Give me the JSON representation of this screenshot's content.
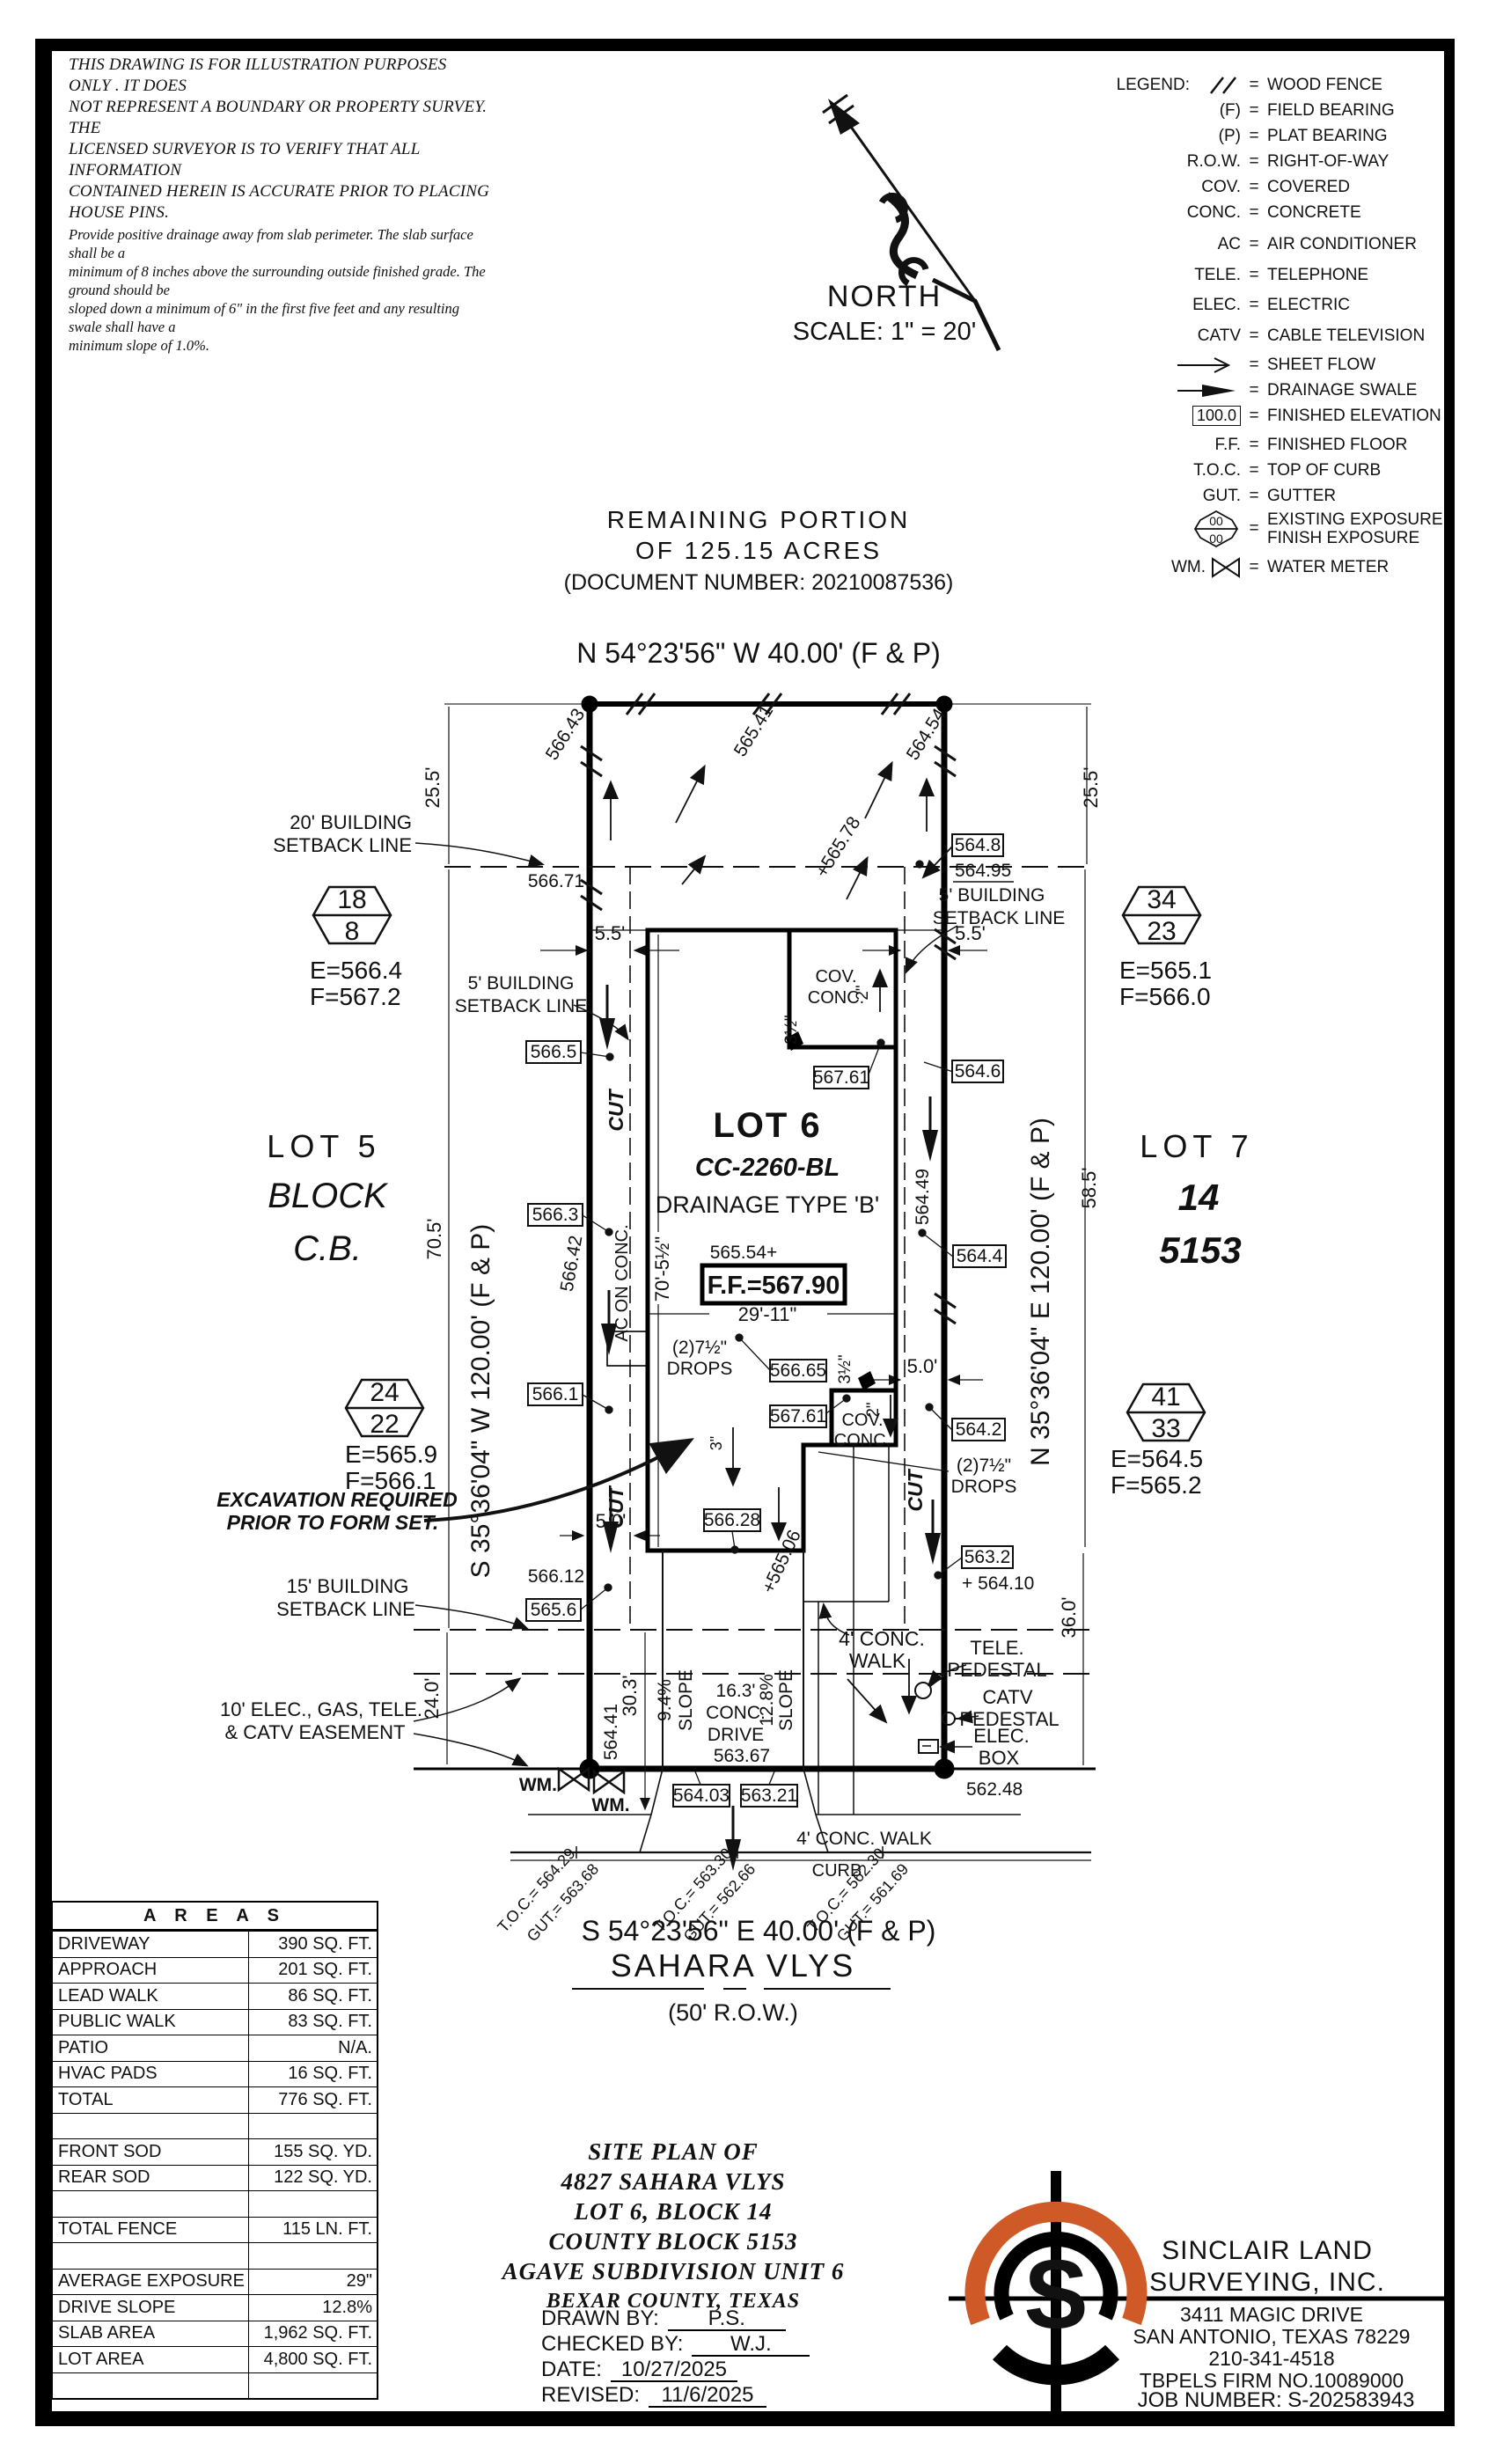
{
  "disclaimer": {
    "l1": "THIS DRAWING IS FOR ILLUSTRATION PURPOSES ONLY . IT DOES",
    "l2": "NOT REPRESENT A BOUNDARY OR PROPERTY SURVEY. THE",
    "l3": "LICENSED SURVEYOR IS TO VERIFY THAT ALL INFORMATION",
    "l4": "CONTAINED HEREIN IS ACCURATE PRIOR TO PLACING HOUSE PINS.",
    "n1": "Provide positive drainage away from slab perimeter. The slab surface shall be a",
    "n2": "minimum of 8 inches above the surrounding outside finished grade. The ground should be",
    "n3": "sloped down a minimum of 6\" in the first five feet and any resulting swale shall have a",
    "n4": "minimum slope of 1.0%."
  },
  "north": {
    "label": "NORTH",
    "scale": "SCALE:  1\" = 20'"
  },
  "legend": {
    "title": "LEGEND:",
    "exp_top": "00",
    "exp_bot": "00",
    "wm": "WM.",
    "items": [
      {
        "sym": "",
        "label": "WOOD FENCE"
      },
      {
        "sym": "(F)",
        "label": "FIELD BEARING"
      },
      {
        "sym": "(P)",
        "label": "PLAT BEARING"
      },
      {
        "sym": "R.O.W.",
        "label": "RIGHT-OF-WAY"
      },
      {
        "sym": "COV.",
        "label": "COVERED"
      },
      {
        "sym": "CONC.",
        "label": "CONCRETE"
      },
      {
        "sym": "AC",
        "label": "AIR CONDITIONER"
      },
      {
        "sym": "TELE.",
        "label": "TELEPHONE"
      },
      {
        "sym": "ELEC.",
        "label": "ELECTRIC"
      },
      {
        "sym": "CATV",
        "label": "CABLE TELEVISION"
      },
      {
        "sym": "",
        "label": "SHEET FLOW"
      },
      {
        "sym": "",
        "label": "DRAINAGE SWALE"
      },
      {
        "sym": "100.0",
        "label": "FINISHED ELEVATION"
      },
      {
        "sym": "F.F.",
        "label": "FINISHED FLOOR"
      },
      {
        "sym": "T.O.C.",
        "label": "TOP OF CURB"
      },
      {
        "sym": "GUT.",
        "label": "GUTTER"
      },
      {
        "sym": "",
        "label": "EXISTING EXPOSURE",
        "label2": "FINISH EXPOSURE"
      },
      {
        "sym": "WM.",
        "label": "WATER METER"
      }
    ]
  },
  "plan": {
    "remaining1": "REMAINING PORTION",
    "remaining2": "OF 125.15 ACRES",
    "remaining3": "(DOCUMENT NUMBER: 20210087536)",
    "top_bearing": "N 54°23'56\" W 40.00' (F & P)",
    "left_bearing": "S 35°36'04\" W 120.00' (F & P)",
    "right_bearing": "N 35°36'04\" E 120.00' (F & P)",
    "bottom_bearing": "S 54°23'56\" E 40.00' (F & P)",
    "street_name": "SAHARA VLYS",
    "street_row": "(50' R.O.W.)",
    "lot5": "LOT 5",
    "block": "BLOCK",
    "cb": "C.B.",
    "lot6": "LOT 6",
    "cc": "CC-2260-BL",
    "drainage": "DRAINAGE TYPE 'B'",
    "pad_elev": "565.54+",
    "ff": "F.F.=567.90",
    "lot7": "LOT 7",
    "b14": "14",
    "cb5153": "5153",
    "sb20a": "20' BUILDING",
    "sb20b": "SETBACK LINE",
    "sb5a": "5' BUILDING",
    "sb5b": "SETBACK LINE",
    "sb15a": "15' BUILDING",
    "sb15b": "SETBACK LINE",
    "ease1": "10' ELEC., GAS, TELE.",
    "ease2": "& CATV EASEMENT",
    "exc1": "EXCAVATION REQUIRED",
    "exc2": "PRIOR TO FORM SET."
  },
  "bm": [
    {
      "a": "18",
      "b": "8",
      "e": "E=566.4",
      "f": "F=567.2"
    },
    {
      "a": "34",
      "b": "23",
      "e": "E=565.1",
      "f": "F=566.0"
    },
    {
      "a": "24",
      "b": "22",
      "e": "E=565.9",
      "f": "F=566.1"
    },
    {
      "a": "41",
      "b": "33",
      "e": "E=564.5",
      "f": "F=565.2"
    }
  ],
  "dims": {
    "d255": "25.5'",
    "d55": "5.5'",
    "d705": "70.5'",
    "d585": "58.5'",
    "d7052": "70'-5½\"",
    "d2911": "29'-11\"",
    "d50": "5.0'",
    "d240": "24.0'",
    "d360": "36.0'",
    "d303": "30.3'",
    "d163a": "16.3'",
    "d163b": "CONC.",
    "d163c": "DRIVE",
    "s94": "9.4%",
    "s128": "12.8%",
    "slope": "SLOPE",
    "d2in": "2\"",
    "d35": "3½\"",
    "d3in": "3\""
  },
  "spots": {
    "s56643": "566.43",
    "s56541": "565.41",
    "s56454": "564.54",
    "s56578": "+565.78",
    "s56671": "566.71",
    "s56495": "564.95",
    "s56642": "566.42",
    "s56449": "564.49",
    "s56506": "+565.06",
    "s56612": "566.12",
    "s56441": "564.41",
    "s56410": "+ 564.10",
    "s56367": "563.67",
    "s56248": "562.48"
  },
  "boxes": {
    "b5665": "566.5",
    "b5663": "566.3",
    "b5661": "566.1",
    "b5656": "565.6",
    "b5648": "564.8",
    "b5646": "564.6",
    "b5644": "564.4",
    "b5642": "564.2",
    "b5632": "563.2",
    "b56665": "566.65",
    "b56761": "567.61",
    "b56628": "566.28",
    "b56403": "564.03",
    "b56321": "563.21"
  },
  "notes": {
    "cut": "CUT",
    "ac": "AC ON CONC.",
    "drops1": "(2)7½\"",
    "drops2": "DROPS",
    "cov": "COV.",
    "conc": "CONC.",
    "walk1": "4' CONC.",
    "walk2": "WALK",
    "walk_b": "4' CONC. WALK",
    "curb": "CURB",
    "wm": "WM."
  },
  "util": {
    "tele1": "TELE.",
    "tele2": "PEDESTAL",
    "catv1": "CATV",
    "catv2": "PEDESTAL",
    "elec1": "ELEC.",
    "elec2": "BOX"
  },
  "toc": [
    {
      "t": "T.O.C.= 564.29",
      "g": "GUT.= 563.68"
    },
    {
      "t": "T.O.C.= 563.30",
      "g": "GUT.= 562.66"
    },
    {
      "t": "T.O.C.= 562.30",
      "g": "GUT.= 561.69"
    }
  ],
  "areas": {
    "title": "A R E A S",
    "rows": [
      {
        "label": "DRIVEWAY",
        "value": "390 SQ. FT."
      },
      {
        "label": "APPROACH",
        "value": "201 SQ. FT."
      },
      {
        "label": "LEAD WALK",
        "value": "86 SQ. FT."
      },
      {
        "label": "PUBLIC WALK",
        "value": "83 SQ. FT."
      },
      {
        "label": "PATIO",
        "value": "N/A."
      },
      {
        "label": "HVAC PADS",
        "value": "16 SQ. FT."
      },
      {
        "label": "TOTAL",
        "value": "776 SQ. FT."
      },
      {
        "label": "",
        "value": ""
      },
      {
        "label": "FRONT SOD",
        "value": "155 SQ. YD."
      },
      {
        "label": "REAR SOD",
        "value": "122 SQ. YD."
      },
      {
        "label": "",
        "value": ""
      },
      {
        "label": "TOTAL FENCE",
        "value": "115  LN. FT."
      },
      {
        "label": "",
        "value": ""
      },
      {
        "label": "AVERAGE EXPOSURE",
        "value": "29\""
      },
      {
        "label": "DRIVE SLOPE",
        "value": "12.8%"
      },
      {
        "label": "SLAB AREA",
        "value": "1,962 SQ. FT."
      },
      {
        "label": "LOT AREA",
        "value": "4,800 SQ. FT."
      },
      {
        "label": "",
        "value": ""
      }
    ]
  },
  "titleblock": {
    "l1": "SITE PLAN OF",
    "l2": "4827 SAHARA VLYS",
    "l3": "LOT 6, BLOCK 14",
    "l4": "COUNTY BLOCK 5153",
    "l5": "AGAVE SUBDIVISION UNIT 6",
    "l6": "BEXAR COUNTY, TEXAS",
    "fields": [
      {
        "label": "DRAWN BY:",
        "value": "P.S."
      },
      {
        "label": "CHECKED BY:",
        "value": "W.J."
      },
      {
        "label": "DATE:",
        "value": "10/27/2025"
      },
      {
        "label": "REVISED:",
        "value": "11/6/2025"
      }
    ]
  },
  "firm": {
    "name1": "SINCLAIR LAND",
    "name2": "SURVEYING, INC.",
    "addr1": "3411 MAGIC DRIVE",
    "addr2": "SAN ANTONIO, TEXAS 78229",
    "phone": "210-341-4518",
    "firmno": "TBPELS FIRM NO.10089000",
    "job": "JOB NUMBER:  S-202583943",
    "logo_s": "S",
    "accent": "#cf5a28"
  }
}
